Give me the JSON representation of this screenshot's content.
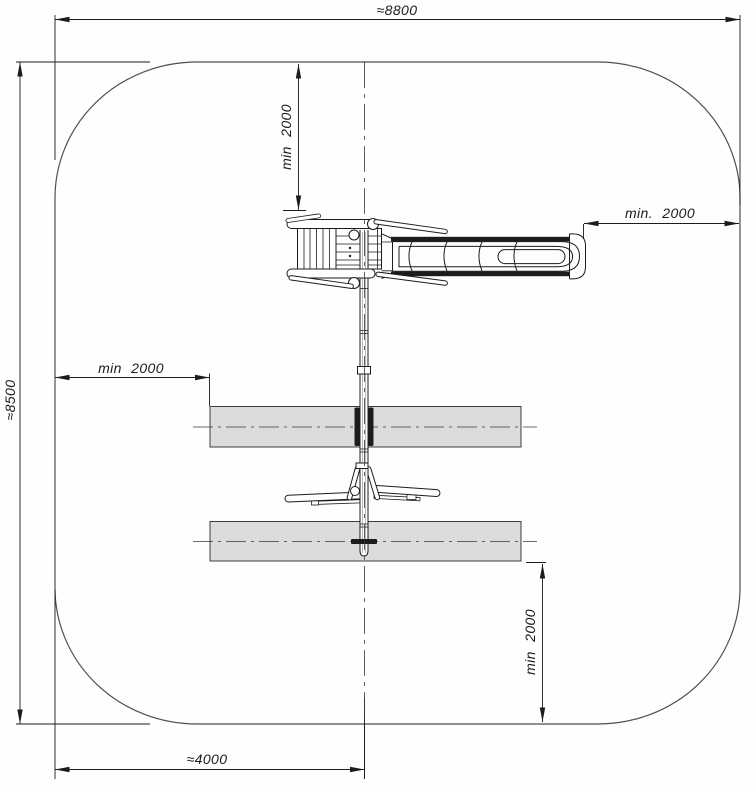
{
  "colors": {
    "paper": "#fefefe",
    "line": "#1c1c1c",
    "dim": "#1c1c1c",
    "boundary": "#4f4f4f",
    "centerline": "#3a3a3a",
    "zone-fill": "#dcdcdc",
    "zone-stroke": "#2b2b2b"
  },
  "dimensions": {
    "overall_width": "≈8800",
    "overall_height": "≈8500",
    "center_offset": "≈4000",
    "clearance_top": "min 2000",
    "clearance_right": "min. 2000",
    "clearance_left": "min 2000",
    "clearance_bottom": "min 2000"
  }
}
